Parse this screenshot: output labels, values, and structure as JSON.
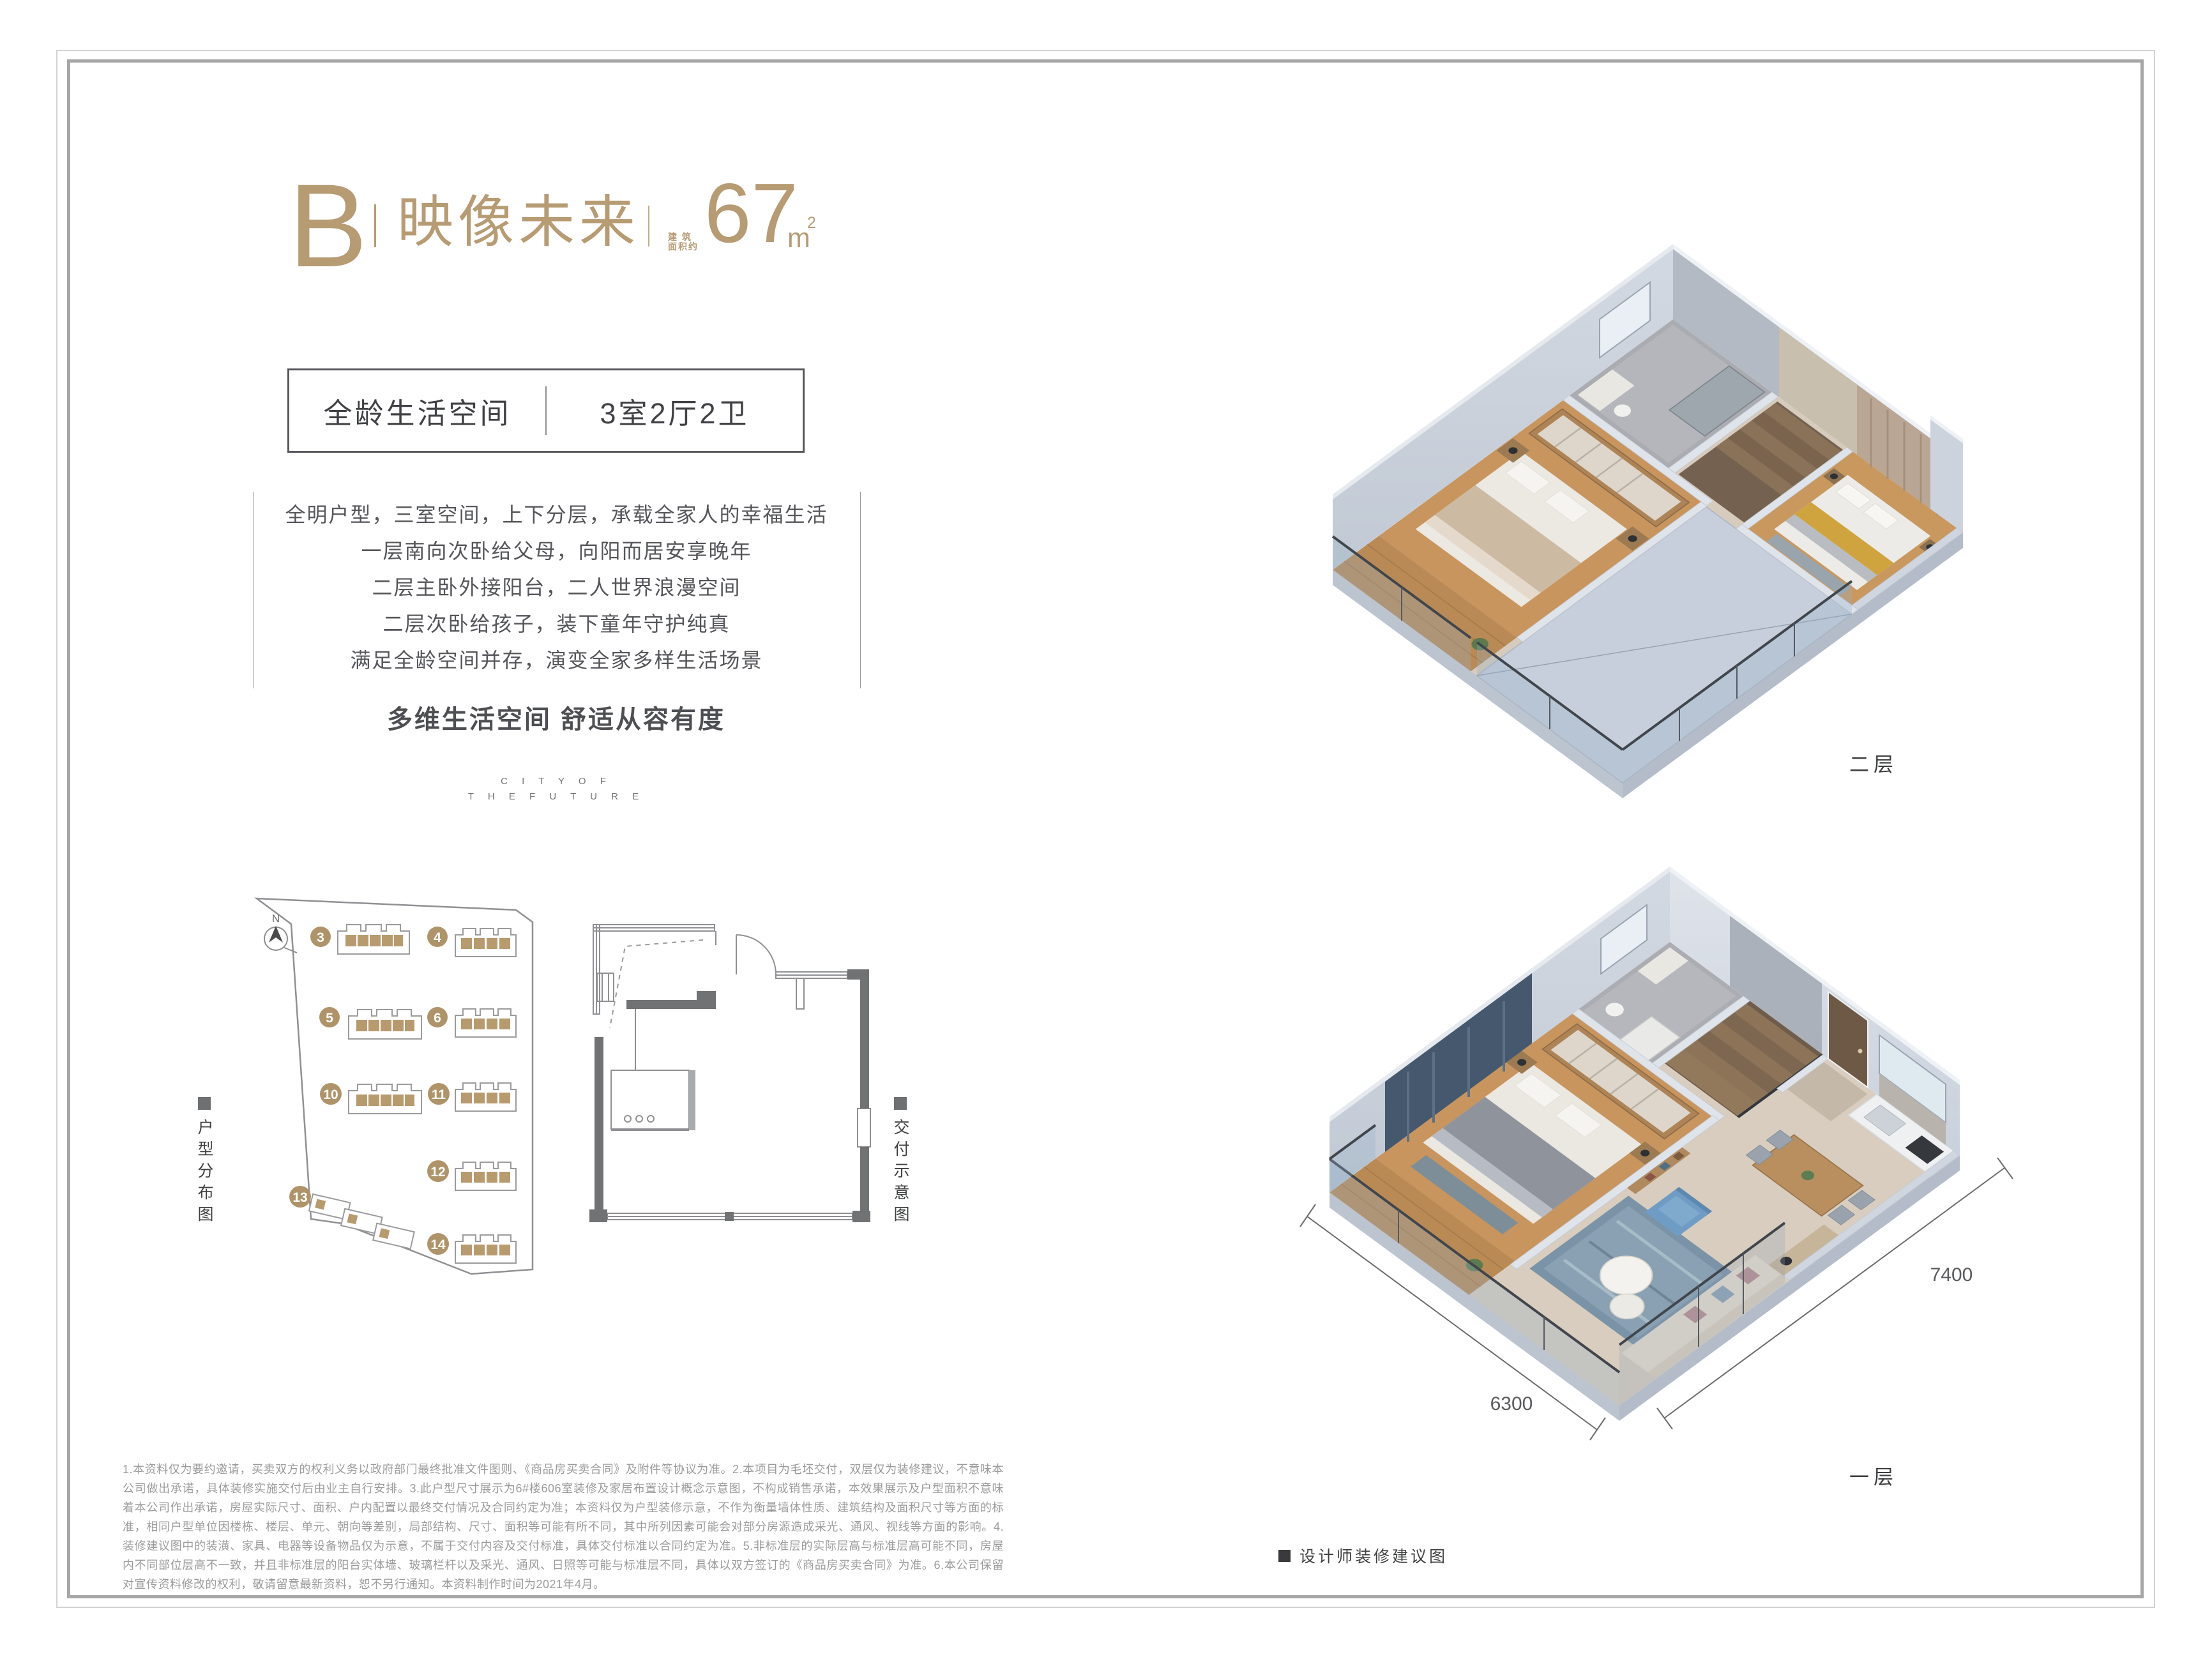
{
  "header": {
    "unit_label": "B",
    "unit_name": "映像未来",
    "area_caption_l1": "建 筑",
    "area_caption_l2": "面积约",
    "area_value": "67",
    "area_unit": "m",
    "area_sup": "2"
  },
  "spec_box": {
    "left": "全龄生活空间",
    "right": "3室2厅2卫"
  },
  "description": {
    "lines": [
      "全明户型，三室空间，上下分层，承载全家人的幸福生活",
      "一层南向次卧给父母，向阳而居安享晚年",
      "二层主卧外接阳台，二人世界浪漫空间",
      "二层次卧给孩子，装下童年守护纯真",
      "满足全龄空间并存，演变全家多样生活场景"
    ]
  },
  "tagline": "多维生活空间 舒适从容有度",
  "watermark": {
    "line1": "C I T Y O F",
    "line2": "T H E F U T U R E"
  },
  "site_map": {
    "label": "户型分布图",
    "north": "N",
    "buildings": [
      "3",
      "4",
      "5",
      "6",
      "10",
      "11",
      "12",
      "13",
      "14"
    ]
  },
  "delivery": {
    "label": "交付示意图"
  },
  "renders": {
    "upper_floor_label": "二层",
    "lower_floor_label": "一层",
    "dim_bottom": "6300",
    "dim_right": "7400",
    "designer_note": "设计师装修建议图"
  },
  "disclaimer": "1.本资料仅为要约邀请，买卖双方的权利义务以政府部门最终批准文件图则、《商品房买卖合同》及附件等协议为准。2.本项目为毛坯交付，双层仅为装修建议，不意味本公司做出承诺，具体装修实施交付后由业主自行安排。3.此户型尺寸展示为6#楼606室装修及家居布置设计概念示意图，不构成销售承诺，本效果展示及户型面积不意味着本公司作出承诺，房屋实际尺寸、面积、户内配置以最终交付情况及合同约定为准；本资料仅为户型装修示意，不作为衡量墙体性质、建筑结构及面积尺寸等方面的标准，相同户型单位因楼栋、楼层、单元、朝向等差别，局部结构、尺寸、面积等可能有所不同，其中所列因素可能会对部分房源造成采光、通风、视线等方面的影响。4.装修建议图中的装潢、家具、电器等设备物品仅为示意，不属于交付内容及交付标准，具体交付标准以合同约定为准。5.非标准层的实际层高与标准层高可能不同，房屋内不同部位层高不一致，并且非标准层的阳台实体墙、玻璃栏杆以及采光、通风、日照等可能与标准层不同，具体以双方签订的《商品房买卖合同》为准。6.本公司保留对宣传资料修改的权利，敬请留意最新资料，恕不另行通知。本资料制作时间为2021年4月。",
  "colors": {
    "gold": "#b69b73",
    "dark_text": "#55565a",
    "muted_text": "#9b9b9b",
    "tan_unit": "#b79a6e"
  }
}
